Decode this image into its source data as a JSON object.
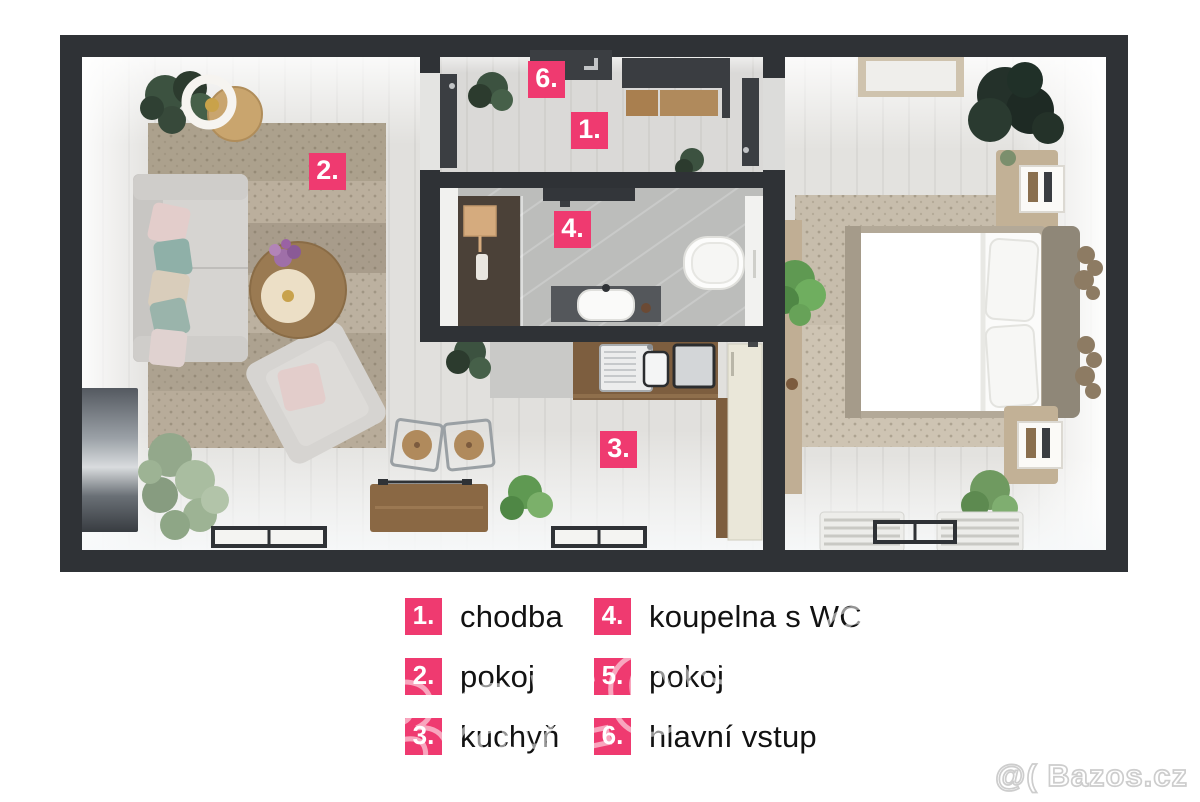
{
  "plan": {
    "markers": [
      {
        "num": "1."
      },
      {
        "num": "2."
      },
      {
        "num": "3."
      },
      {
        "num": "4."
      },
      {
        "num": "6."
      }
    ]
  },
  "legend": {
    "items": [
      {
        "num": "1.",
        "label": "chodba"
      },
      {
        "num": "2.",
        "label": "pokoj"
      },
      {
        "num": "3.",
        "label": "kuchyň"
      },
      {
        "num": "4.",
        "label": "koupelna s WC"
      },
      {
        "num": "5.",
        "label": "pokoj"
      },
      {
        "num": "6.",
        "label": "hlavní vstup"
      }
    ]
  },
  "watermark": {
    "corner": "@( Bazos.cz",
    "site": "Bazos.cz"
  },
  "colors": {
    "accent_pink": "#ef3a70",
    "wall_dark": "#2f3236",
    "floor_light": "#e1e0dd",
    "bath_tile": "#bcbdbb",
    "rug_living": "#b2a794",
    "rug_bedroom": "#cec4b3",
    "legend_text": "#121212",
    "watermark_gray": "#cdcdcd"
  }
}
